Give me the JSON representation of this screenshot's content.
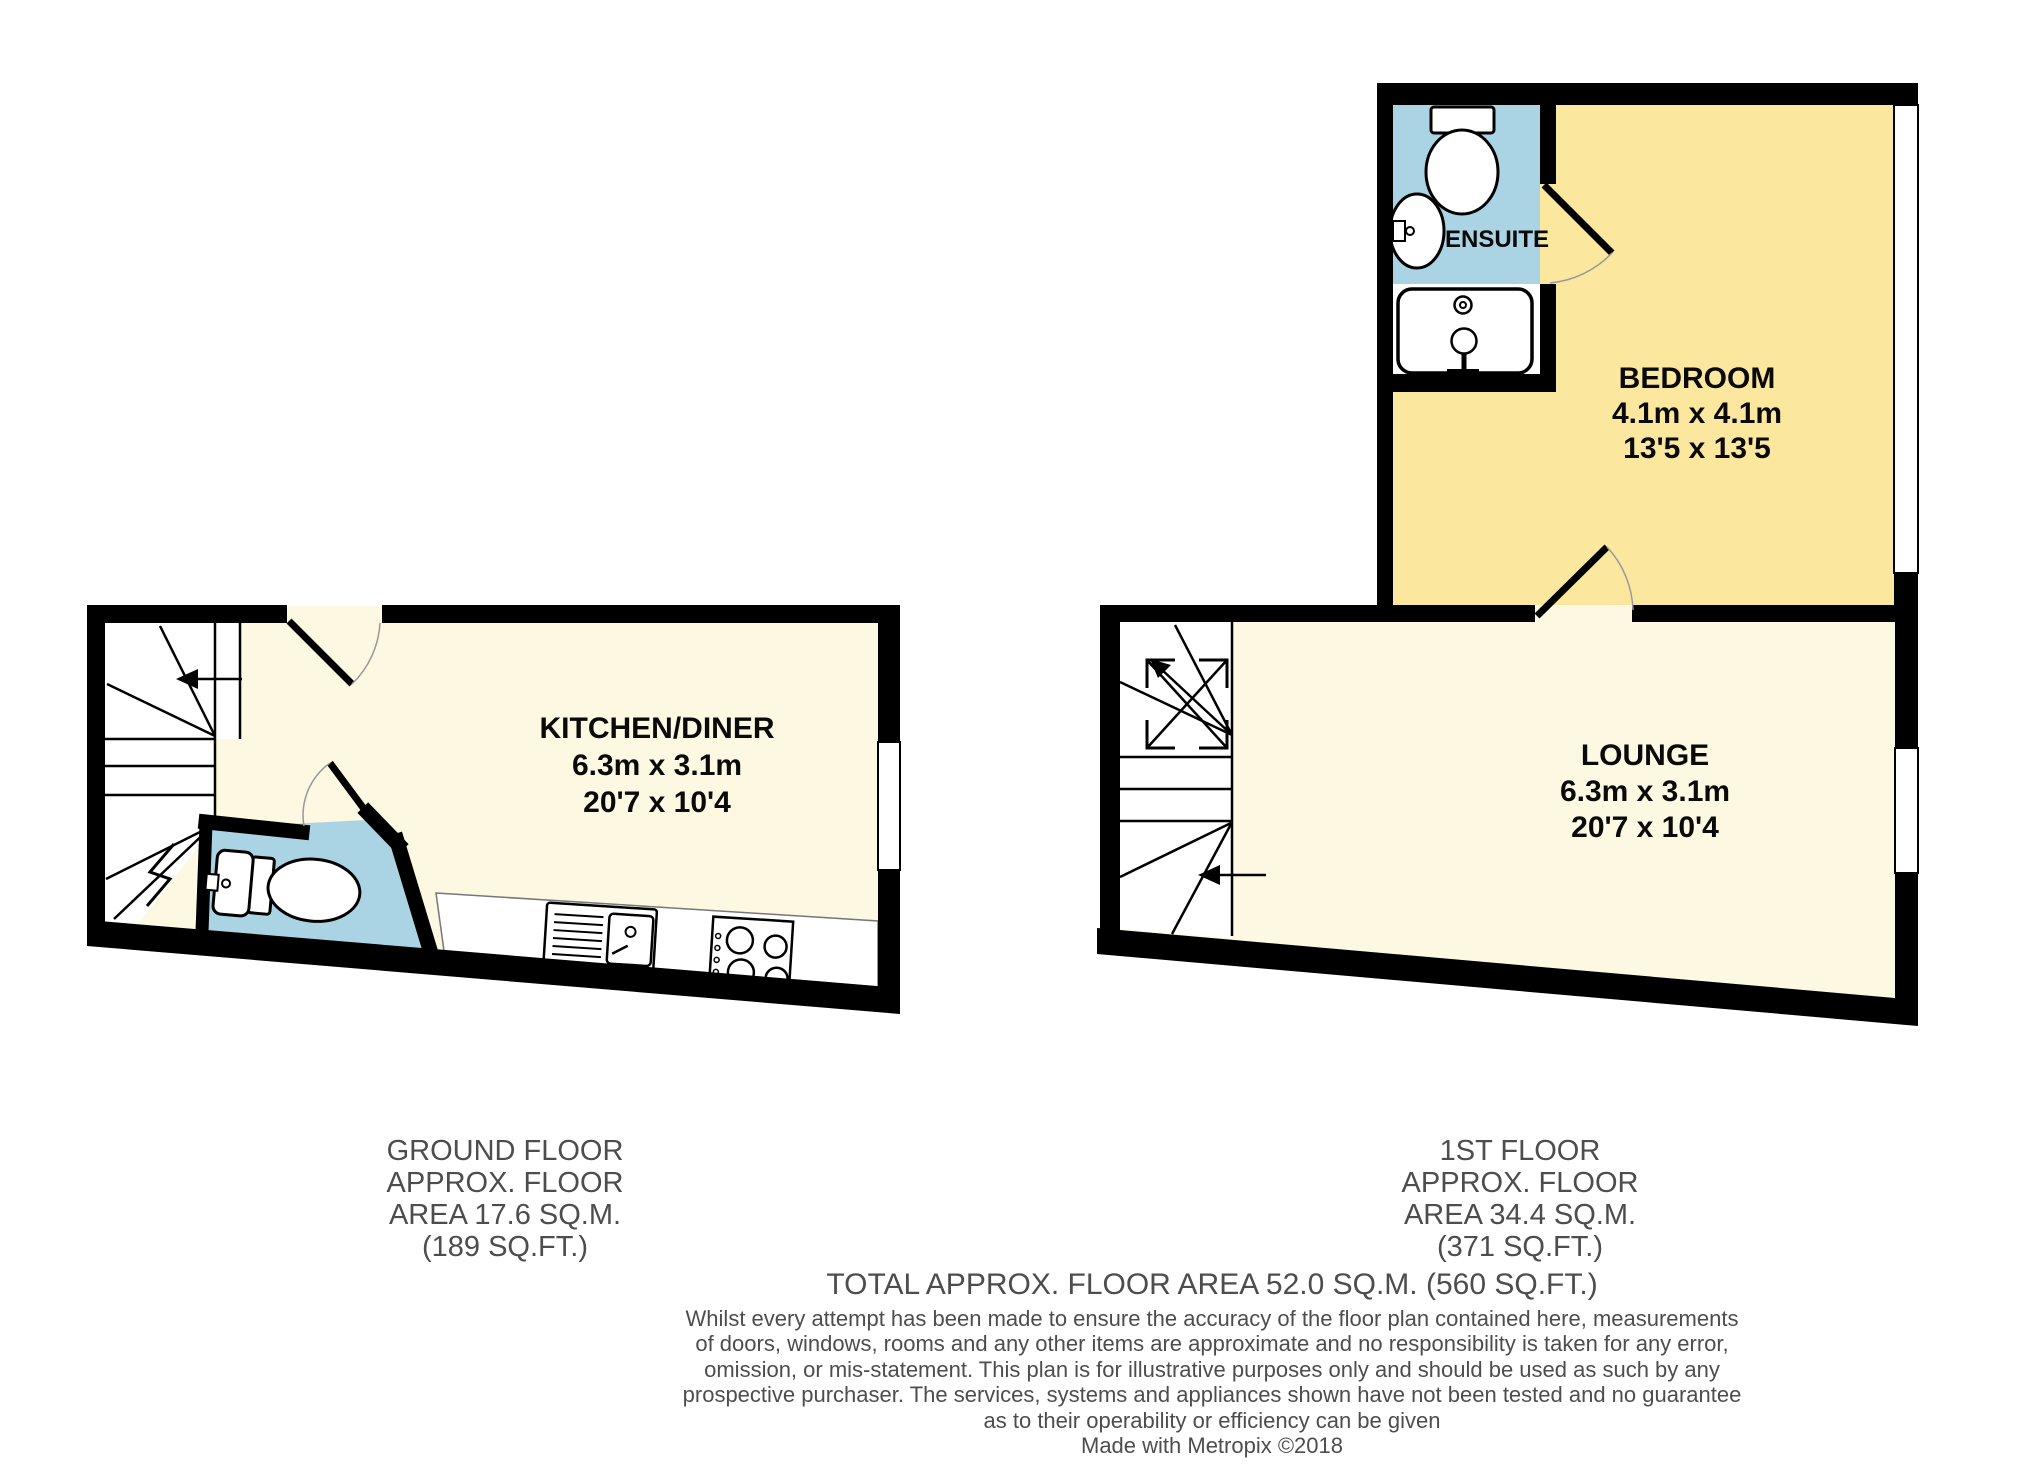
{
  "ground_floor": {
    "kitchen": {
      "name": "KITCHEN/DINER",
      "size_metric": "6.3m x 3.1m",
      "size_imperial": "20'7 x 10'4"
    },
    "caption": {
      "line1": "GROUND FLOOR",
      "line2": "APPROX. FLOOR",
      "line3": "AREA 17.6 SQ.M.",
      "line4": "(189 SQ.FT.)"
    }
  },
  "first_floor": {
    "bedroom": {
      "name": "BEDROOM",
      "size_metric": "4.1m x 4.1m",
      "size_imperial": "13'5 x 13'5"
    },
    "lounge": {
      "name": "LOUNGE",
      "size_metric": "6.3m x 3.1m",
      "size_imperial": "20'7 x 10'4"
    },
    "ensuite": {
      "name": "ENSUITE"
    },
    "caption": {
      "line1": "1ST FLOOR",
      "line2": "APPROX. FLOOR",
      "line3": "AREA 34.4 SQ.M.",
      "line4": "(371 SQ.FT.)"
    }
  },
  "footer": {
    "total": "TOTAL APPROX. FLOOR AREA 52.0 SQ.M. (560 SQ.FT.)",
    "disclaimer_lines": [
      "Whilst every attempt has been made to ensure the accuracy of the floor plan contained here, measurements",
      "of doors, windows, rooms and any other items are approximate and no responsibility is taken for any error,",
      "omission, or mis-statement. This plan is for illustrative purposes only and should be used as such by any",
      "prospective purchaser. The services, systems and appliances shown have not been tested and no guarantee",
      "as to their operability or efficiency can be given"
    ],
    "credit": "Made with Metropix ©2018"
  },
  "colors": {
    "bedroom_yellow": "#FCE79F",
    "floor_cream": "#FCF8E1",
    "wet_room_blue": "#AAD4E4",
    "wall_black": "#000000",
    "caption_gray": "#4D4D4D"
  }
}
